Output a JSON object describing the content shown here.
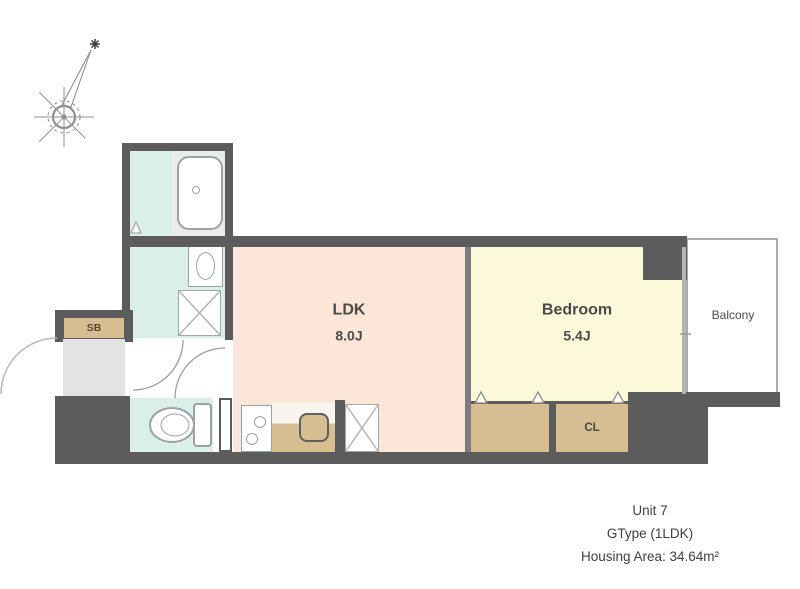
{
  "colors": {
    "wall": "#5c5c5c",
    "ldk": "#fbe6d7",
    "bedroom": "#fbf9d9",
    "wet": "#d9efe8",
    "storage": "#d6bd92",
    "entrance": "#e3e3e3",
    "outline": "#9aa2a2",
    "text": "#4a4a4a"
  },
  "rooms": {
    "ldk": {
      "label": "LDK",
      "area": "8.0J"
    },
    "bedroom": {
      "label": "Bedroom",
      "area": "5.4J"
    },
    "balcony": {
      "label": "Balcony"
    },
    "shoe_box": {
      "label": "SB"
    },
    "closet": {
      "label": "CL"
    }
  },
  "footer": {
    "unit": "Unit 7",
    "type": "GType (1LDK)",
    "area": "Housing Area: 34.64m²"
  }
}
